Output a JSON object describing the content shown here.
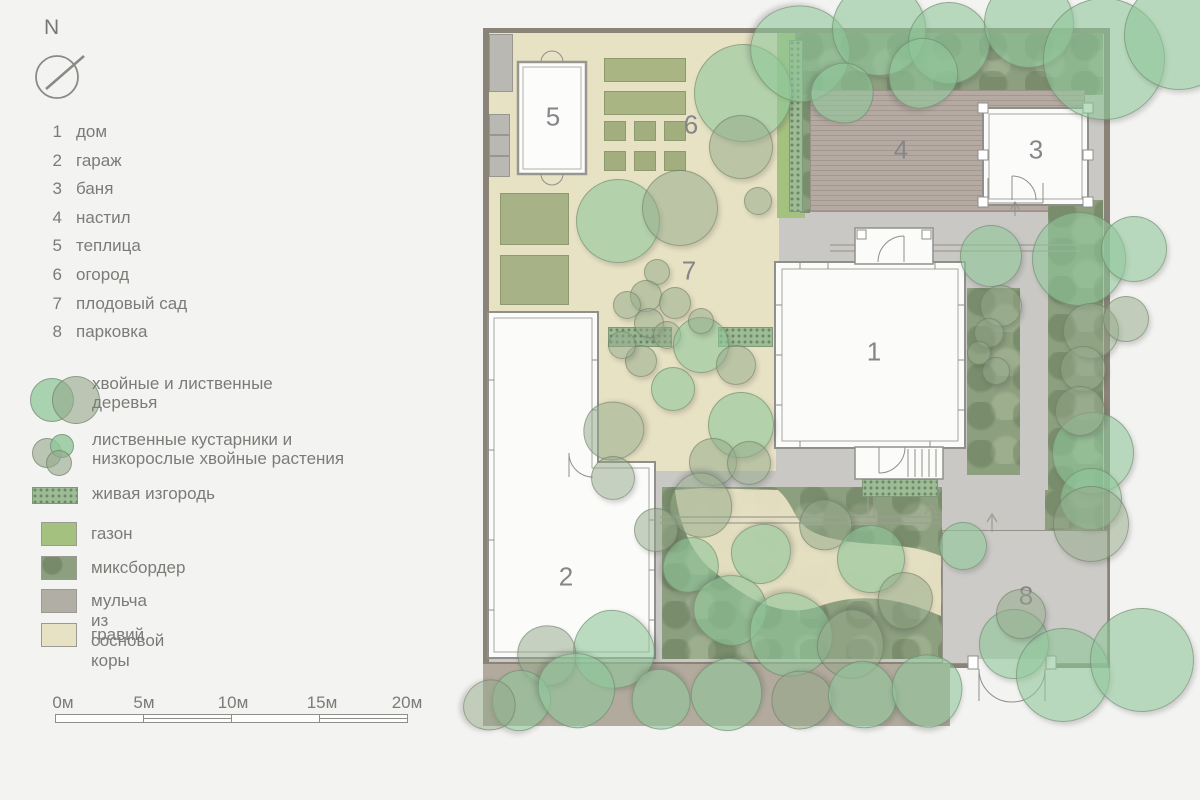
{
  "compass": {
    "north_label": "N"
  },
  "legend": {
    "items": [
      {
        "num": "1",
        "label": "дом"
      },
      {
        "num": "2",
        "label": "гараж"
      },
      {
        "num": "3",
        "label": "баня"
      },
      {
        "num": "4",
        "label": "настил"
      },
      {
        "num": "5",
        "label": "теплица"
      },
      {
        "num": "6",
        "label": "огород"
      },
      {
        "num": "7",
        "label": "плодовый сад"
      },
      {
        "num": "8",
        "label": "парковка"
      }
    ],
    "plants": [
      {
        "line1": "хвойные и лиственные",
        "line2": "деревья"
      },
      {
        "line1": "лиственные кустарники и",
        "line2": "низкорослые хвойные растения"
      },
      {
        "line1": "живая изгородь",
        "line2": ""
      }
    ],
    "surfaces": [
      {
        "label": "газон",
        "color": "#a5c17f"
      },
      {
        "label": "миксбордер",
        "color": "#8c9f7e"
      },
      {
        "label": "мульча из сосновой коры",
        "color": "#b1afa5"
      },
      {
        "label": "гравий",
        "color": "#e8e2c4"
      }
    ]
  },
  "scalebar": {
    "labels": [
      "0м",
      "5м",
      "10м",
      "15м",
      "20м"
    ]
  },
  "plan": {
    "labels": [
      "1",
      "2",
      "3",
      "4",
      "5",
      "6",
      "7",
      "8"
    ]
  },
  "colors": {
    "page_bg": "#f3f3f1",
    "paving": "#c9c8c4",
    "gravel": "#e8e2c4",
    "lawn": "#a5c17f",
    "mixborder": "#8c9f7e",
    "mulch_band": "#b2aa9d",
    "deck": "#b3a89f",
    "fence": "#8a8478",
    "outline": "#8f8f8b",
    "tree_light": "#8fc79a",
    "tree_sage": "#94a98b",
    "hedge": "#9dbb95",
    "text": "#7b7b78",
    "plan_label": "#85858a"
  }
}
